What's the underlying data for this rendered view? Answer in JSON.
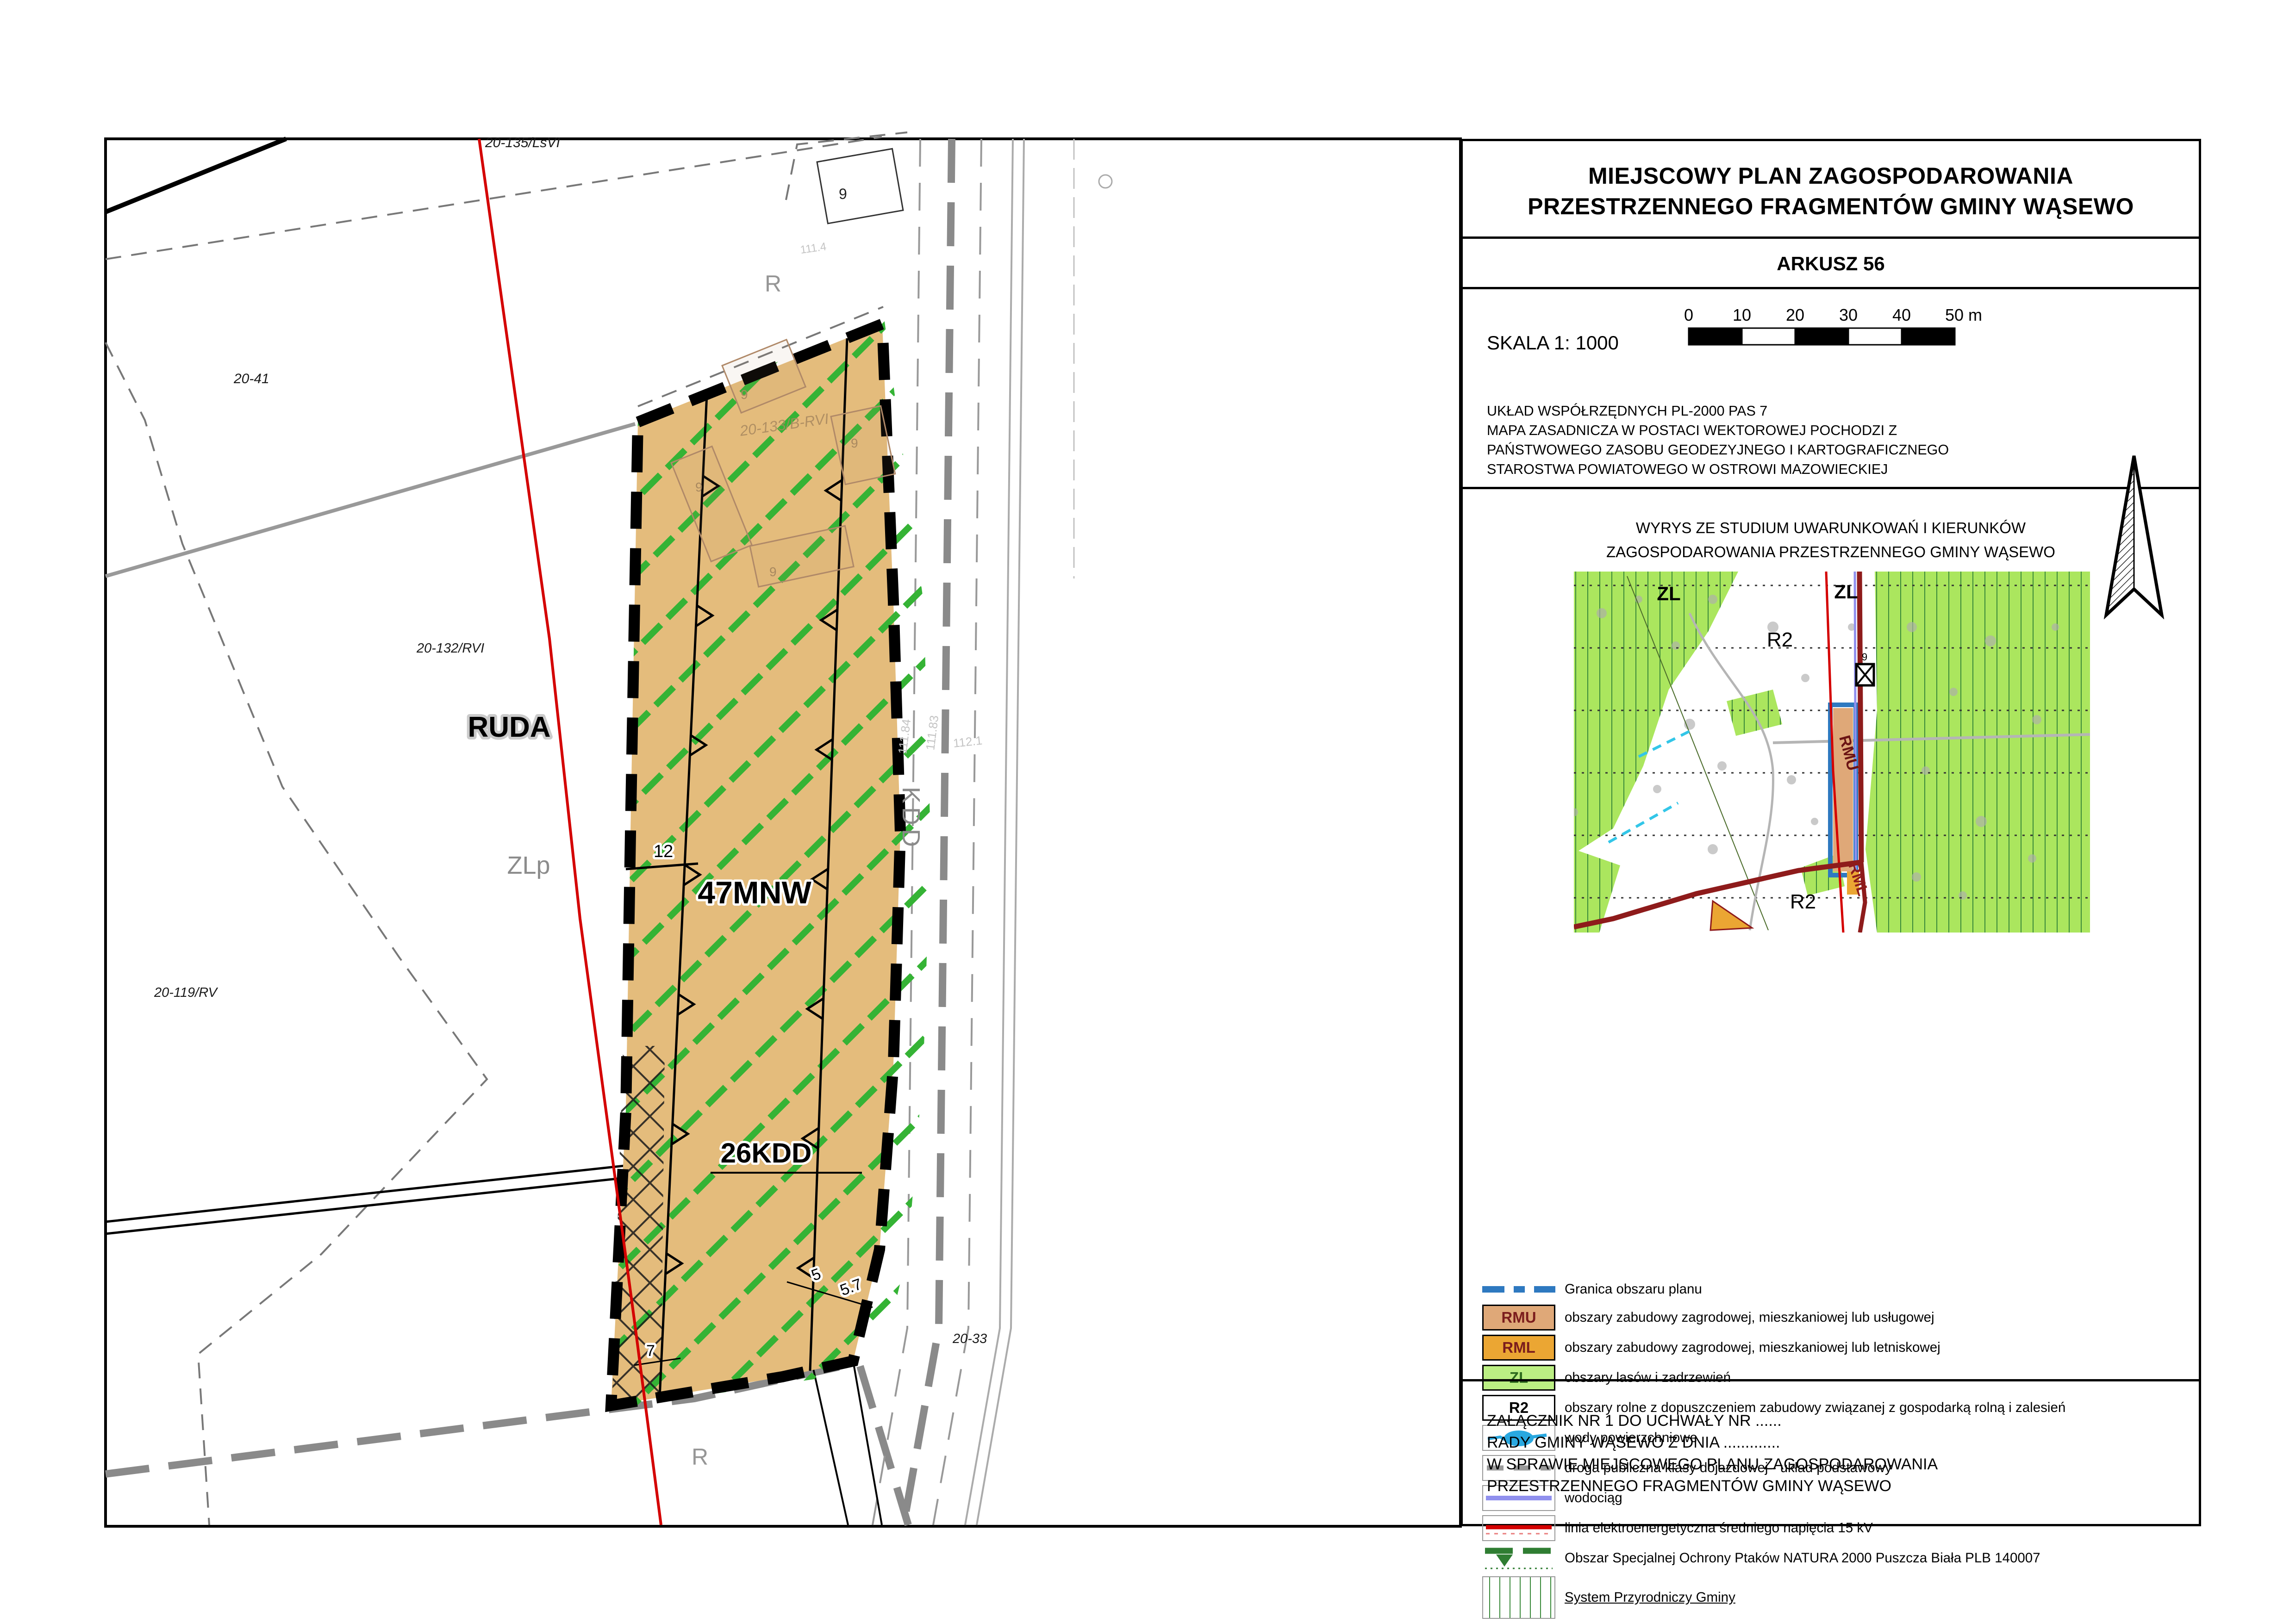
{
  "title_block": {
    "title_line1": "MIEJSCOWY PLAN ZAGOSPODAROWANIA",
    "title_line2": "PRZESTRZENNEGO FRAGMENTÓW GMINY WĄSEWO",
    "sheet": "ARKUSZ 56"
  },
  "scale_block": {
    "scale_label": "SKALA 1: 1000",
    "ticks": [
      "0",
      "10",
      "20",
      "30",
      "40",
      "50 m"
    ],
    "source_lines": [
      "UKŁAD WSPÓŁRZĘDNYCH PL-2000 PAS 7",
      "MAPA ZASADNICZA W POSTACI WEKTOROWEJ POCHODZI Z",
      "PAŃSTWOWEGO ZASOBU GEODEZYJNEGO I KARTOGRAFICZNEGO",
      "STAROSTWA POWIATOWEGO W OSTROWI MAZOWIECKIEJ"
    ]
  },
  "studium": {
    "heading_line1": "WYRYS ZE STUDIUM UWARUNKOWAŃ I KIERUNKÓW",
    "heading_line2": "ZAGOSPODAROWANIA PRZESTRZENNEGO GMINY WĄSEWO",
    "labels": {
      "zl_left": "ZL",
      "zl_right": "ZL",
      "r2_upper": "R2",
      "r2_lower": "R2",
      "rmu": "RMU",
      "rml": "RML",
      "b": "9"
    }
  },
  "legend": {
    "boundary_label": "Granica obszaru planu",
    "items": [
      {
        "code": "RMU",
        "label": "obszary zabudowy zagrodowej, mieszkaniowej lub usługowej"
      },
      {
        "code": "RML",
        "label": "obszary zabudowy zagrodowej, mieszkaniowej lub letniskowej"
      },
      {
        "code": "ZL",
        "label": "obszary lasów i zadrzewień"
      },
      {
        "code": "R2",
        "label": "obszary rolne z dopuszczeniem zabudowy związanej z gospodarką rolną i zalesień"
      },
      {
        "label": "wody powierzchniowe"
      },
      {
        "label": "droga publiczna klasy dojazdowej - układ podstawowy"
      },
      {
        "label": "wodociąg"
      },
      {
        "label": "linia elektroenergetyczna średniego napięcia 15 kV"
      },
      {
        "label": "Obszar Specjalnej Ochrony Ptaków NATURA 2000 Puszcza Biała PLB 140007"
      },
      {
        "label": "System Przyrodniczy Gminy"
      },
      {
        "symbol_text": "B, K, G",
        "label": "obiekty o wysokich wartościach historycznych i kulturowych (budynki, kapliczki, groby wojenne)"
      },
      {
        "label": "obowiązujące plany miejscowe"
      }
    ]
  },
  "annex": {
    "lines": [
      "ZAŁĄCZNIK NR 1 DO UCHWAŁY NR ......",
      "RADY GMINY WĄSEWO Z DNIA .............",
      "W SPRAWIE MIEJSCOWEGO PLANU ZAGOSPODAROWANIA",
      "PRZESTRZENNEGO FRAGMENTÓW GMINY WĄSEWO"
    ]
  },
  "map": {
    "zone_label_47mnw": "47MNW",
    "zone_label_26kdd": "26KDD",
    "village_label": "RUDA",
    "zlp_label": "ZLp",
    "kdd_road_label": "KDD",
    "r_label_top": "R",
    "r_label_bottom": "R",
    "building_label": "9",
    "parcels": {
      "p20_41": "20-41",
      "p20_132": "20-132/RVI",
      "p20_135": "20-135/LsVI",
      "p20_119": "20-119/RV",
      "p20_133": "20-133/B-RVI",
      "p20_33": "20-33",
      "p12": "12"
    },
    "dims": {
      "d5": "5",
      "d57": "5.7",
      "d7": "7"
    },
    "road_numbers": {
      "n1": "111.84",
      "n2": "111.83",
      "n3": "112.1",
      "n4": "111.4"
    }
  },
  "colors": {
    "plan_fill": "#E4BC7C",
    "natura_green": "#35b335",
    "boundary_black": "#000000",
    "granica_blue": "#2E79C0",
    "rmu_tan": "#DFA878",
    "rml_orange": "#EBA633",
    "zl_green": "#BBEF83",
    "power_red": "#D40000",
    "wodociag_violet": "#9090EE",
    "plans_darkred": "#8E1B1B",
    "inset_green": "#ABE65E"
  }
}
